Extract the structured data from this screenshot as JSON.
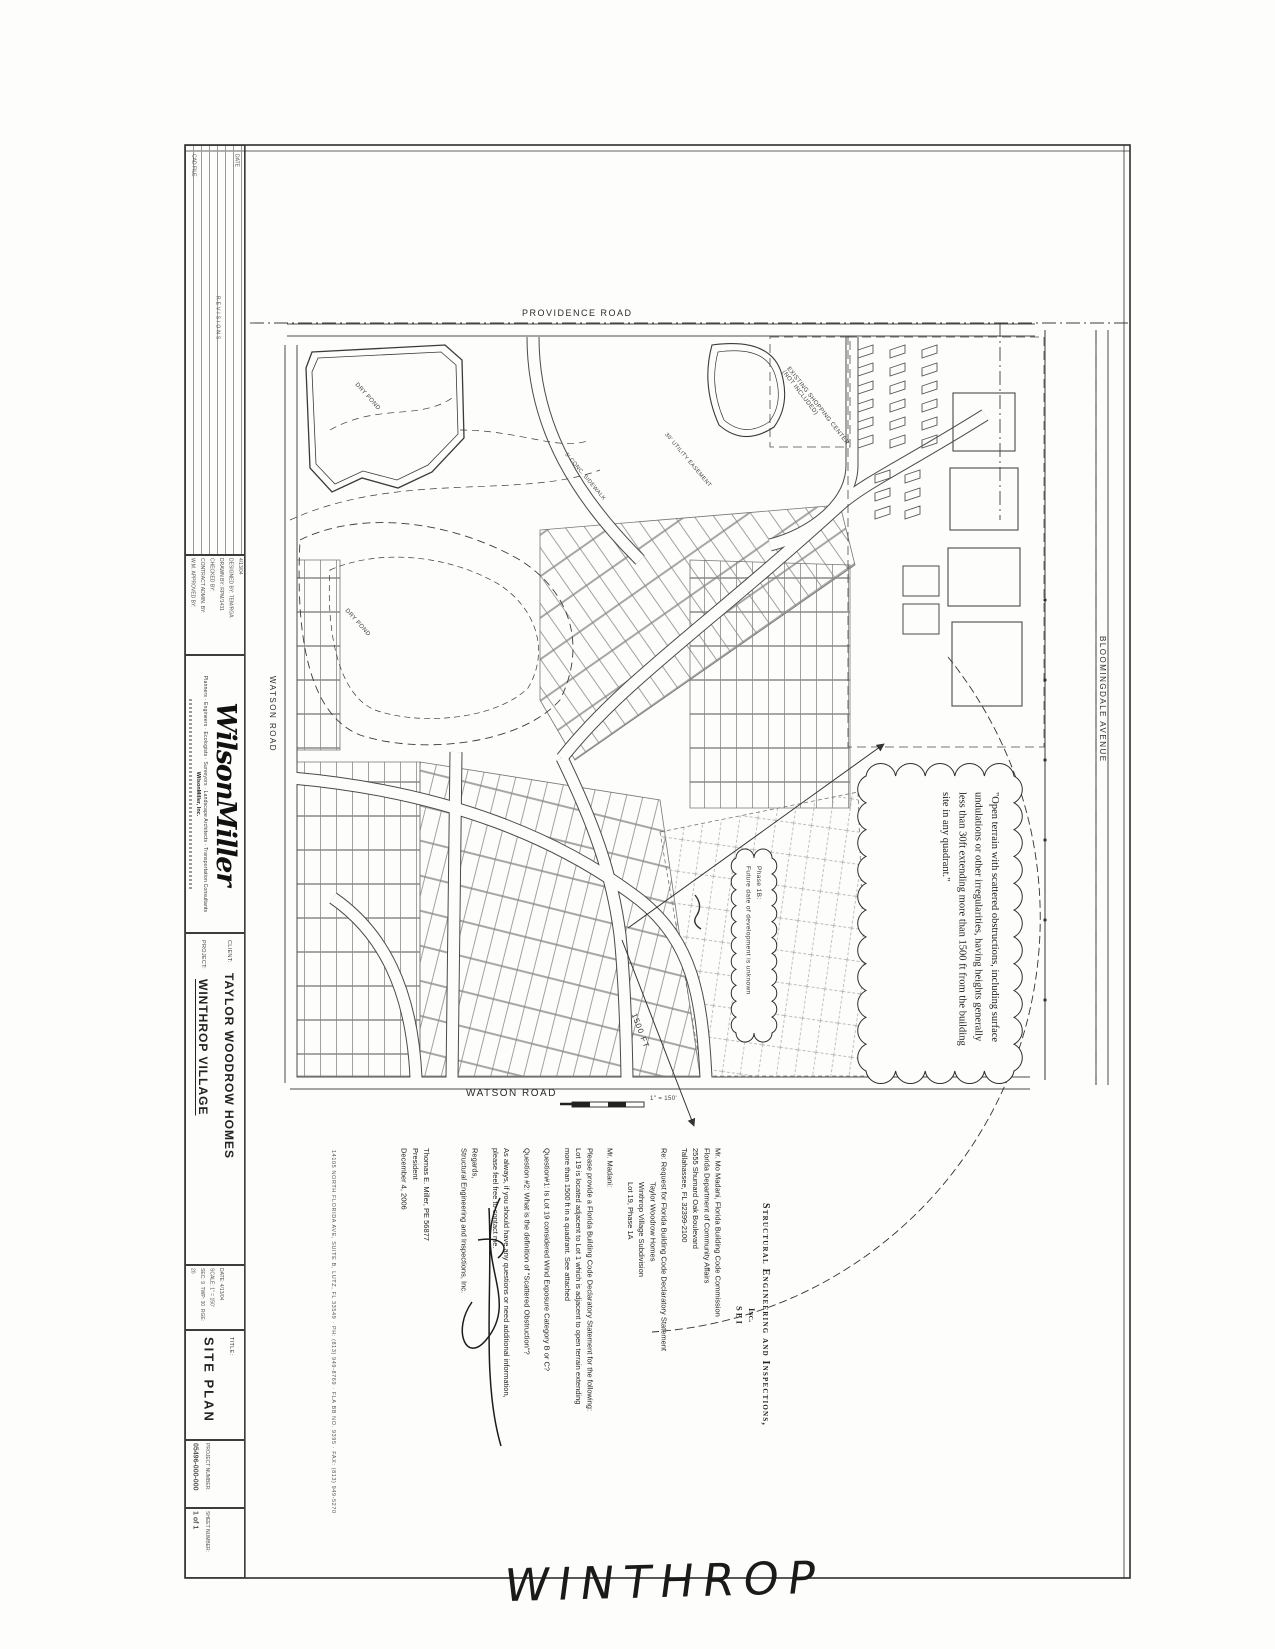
{
  "page": {
    "handwritten_note": "WINTHROP"
  },
  "title_block": {
    "revisions_header": "REVISIONS",
    "cad_file_label": "CAD FILE",
    "date_col_label": "DATE",
    "rev_date": "4/13/04",
    "designed_by_label": "DESIGNED BY:",
    "designed_by": "TEM/RGA",
    "drawn_by_label": "DRAWN BY:",
    "drawn_by": "RPM/1431",
    "checked_by_label": "CHECKED BY:",
    "contract_admin_label": "CONTRACT ADMIN. BY:",
    "wm_approved_label": "W.M. APPROVED BY:",
    "logo": "WilsonMiller",
    "tagline": "Planners · Engineers · Ecologists · Surveyors · Landscape Architects · Transportation Consultants",
    "firm": "WilsonMiller, Inc.",
    "client_label": "CLIENT:",
    "client": "TAYLOR WOODROW HOMES",
    "project_label": "PROJECT:",
    "project": "WINTHROP VILLAGE",
    "date_label": "DATE:",
    "date": "4/13/04",
    "scale_label": "SCALE:",
    "scale": "1\" = 150'",
    "sec_label": "SEC:",
    "sec": "9",
    "twp_label": "TWP:",
    "twp": "30",
    "rge_label": "RGE:",
    "rge": "20",
    "title_label": "TITLE:",
    "title": "SITE PLAN",
    "project_number_label": "PROJECT NUMBER:",
    "project_number": "05496-000-000",
    "sheet_number_label": "SHEET NUMBER:",
    "sheet_number": "1 of 1"
  },
  "map": {
    "roads": {
      "providence": "PROVIDENCE ROAD",
      "watson_left": "WATSON ROAD",
      "watson_bottom": "WATSON ROAD",
      "bloomingdale": "BLOOMINGDALE AVENUE"
    },
    "labels": {
      "dry_pond_1": "DRY POND",
      "dry_pond_2": "DRY POND",
      "shopping_center_1": "EXISTING SHOPPING CENTER",
      "shopping_center_2": "(NOT INCLUDED)",
      "utility_easement": "30' UTILITY EASEMENT",
      "sidewalk": "5' CONC. SIDEWALK",
      "radius": "1500 FT",
      "scale_bar": "1\" = 150'"
    },
    "callouts": {
      "exposure_quote": "\"Open terrain with scattered obstructions, including surface undulations or other irregularities, having heights generally less than 30ft extending more than 1500 ft from the building site in any quadrant.\"",
      "phase_1b_line1": "Phase 1B:",
      "phase_1b_line2": "Future date of development is unknown"
    }
  },
  "letter": {
    "lines": [
      "Structural Engineering and Inspections,",
      "Inc.",
      "S E I",
      "Mr. Mo Madani, Florida Building Code Commission",
      "Florida Department of Community Affairs",
      "2555 Shumard Oak Boulevard",
      "Tallahassee, FL  32399-2100",
      "Re:      Request for Florida Building Code Declaratory Statement",
      "Taylor Woodrow Homes",
      "Winthrop Village Subdivision",
      "Lot 19, Phase 1A",
      "Mr. Madani:",
      "Please provide a Florida Building Code Declaratory Statement for the following:",
      "Lot 19 is located adjacent to Lot 1 which is adjacent to open terrain extending",
      "more than 1500 ft in a quadrant.  See attached",
      "Question#1:  Is Lot 19 considered Wind Exposure Category B or C?",
      "Question #2:  What is the definition of \"Scattered Obstruction\"?",
      "As always, if you should have any questions or need additional information,",
      "please feel free to contact me.",
      "Regards,",
      "Structural Engineering and Inspections, Inc.",
      "Thomas E. Miller, PE 56877",
      "President",
      "December 4, 2006"
    ],
    "footer": "14105 NORTH FLORIDA AVE, SUITE B, LUTZ, FL 33549   ·   PH: (813) 949-8769   ·   FLA BB NO. 9395   ·   FAX: (813) 949-5270"
  }
}
